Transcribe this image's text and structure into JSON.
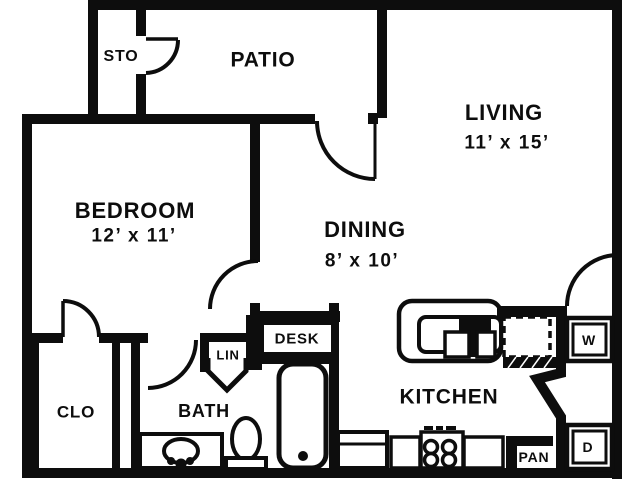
{
  "image": {
    "type": "apartment-floor-plan",
    "width": 639,
    "height": 479
  },
  "colors": {
    "ink": "#0d0d0d",
    "paper": "#ffffff"
  },
  "rooms": {
    "storage": {
      "label": "STO"
    },
    "patio": {
      "label": "PATIO"
    },
    "living": {
      "label": "LIVING",
      "dims": "11’ x 15’"
    },
    "bedroom": {
      "label": "BEDROOM",
      "dims": "12’ x 11’"
    },
    "dining": {
      "label": "DINING",
      "dims": "8’ x 10’"
    },
    "kitchen": {
      "label": "KITCHEN"
    },
    "bath": {
      "label": "BATH"
    },
    "closet": {
      "label": "CLO"
    },
    "linen": {
      "label": "LIN"
    },
    "desk": {
      "label": "DESK"
    },
    "pantry": {
      "label": "PAN"
    },
    "washer": {
      "label": "W"
    },
    "dryer": {
      "label": "D"
    }
  }
}
